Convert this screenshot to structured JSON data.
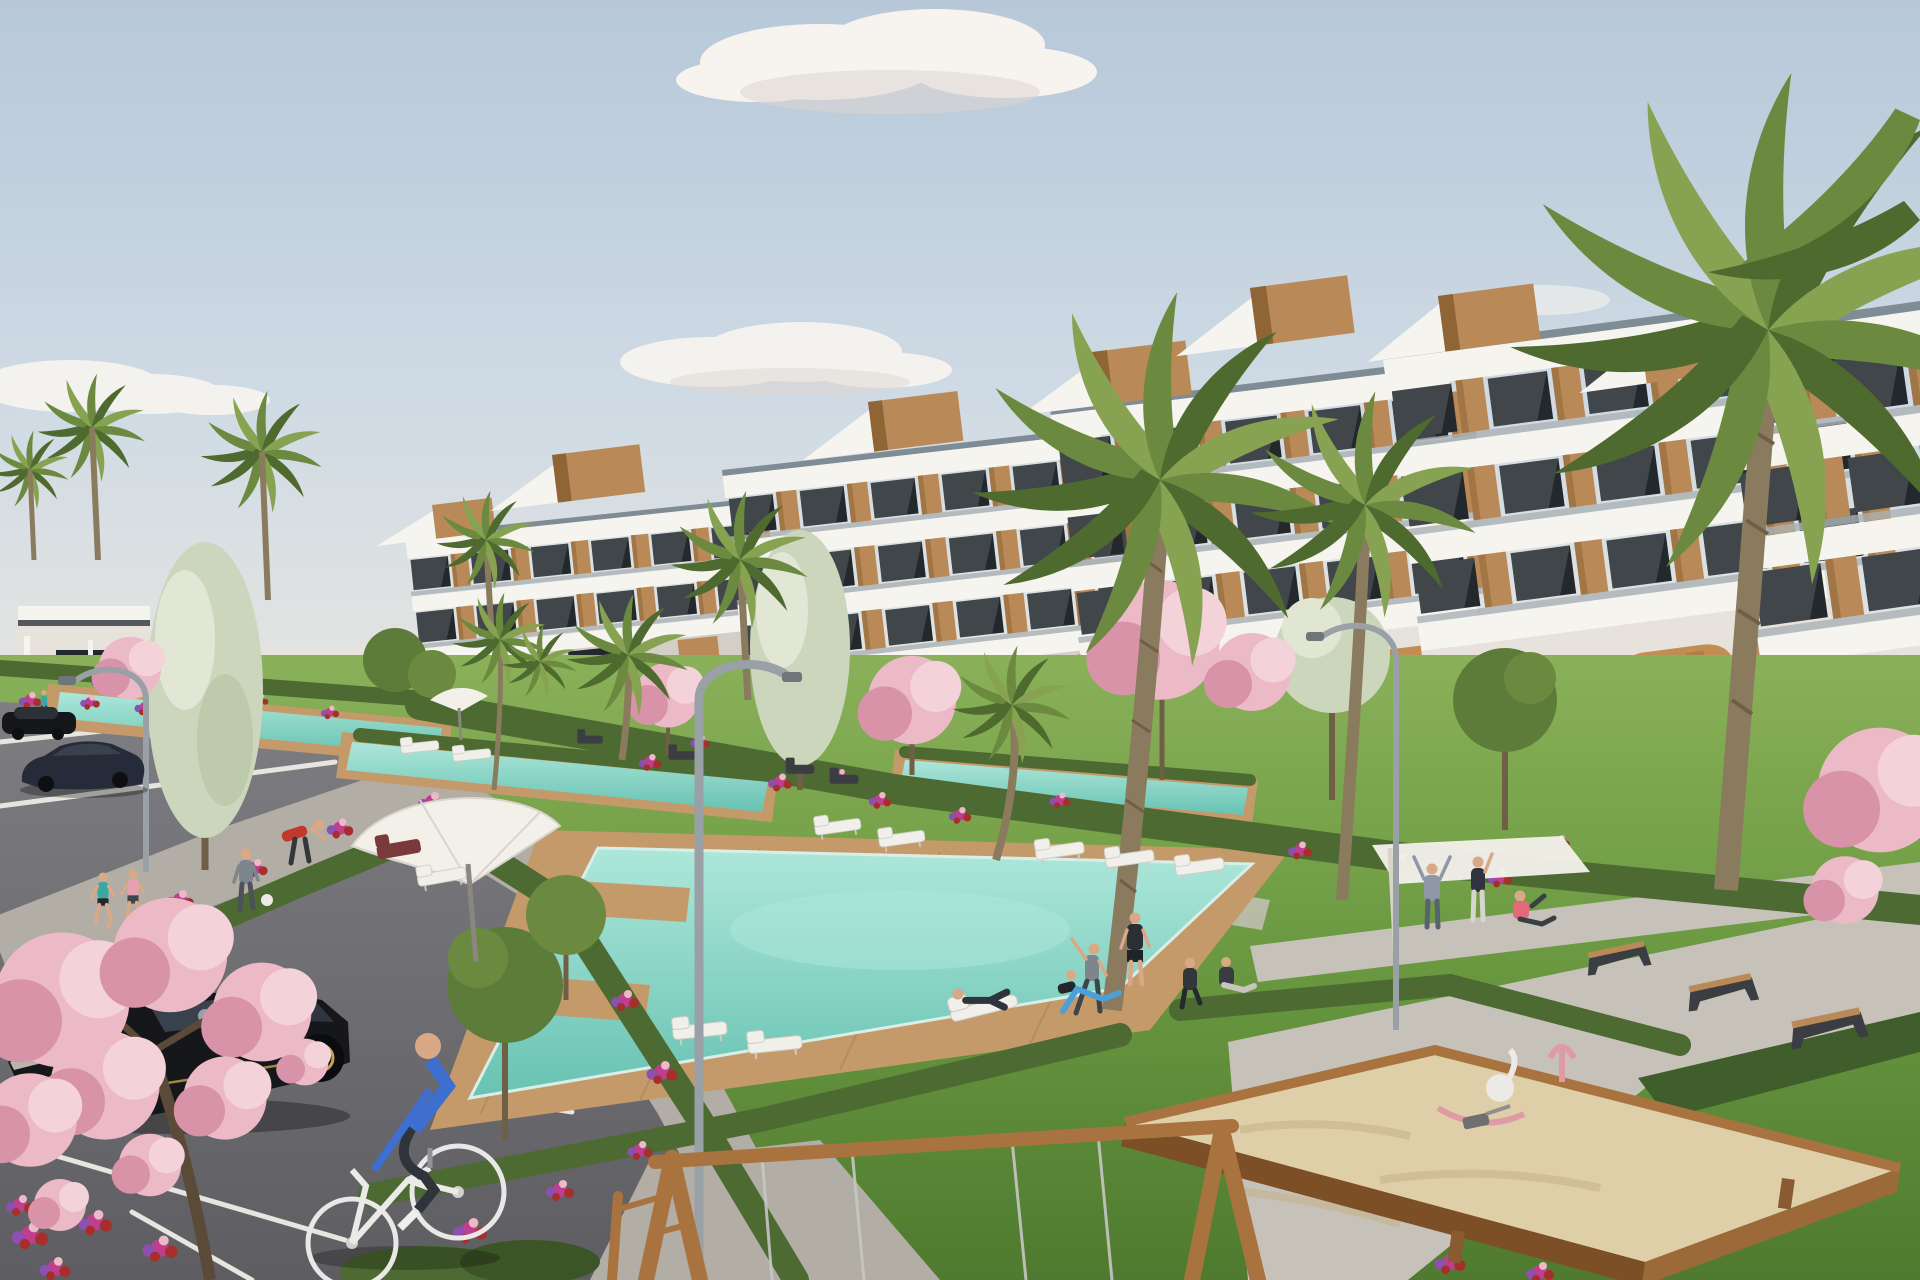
{
  "scene": {
    "description": "Sunny 3D architectural rendering of a modern white terraced apartment complex with rooftop wood accents, communal gardens with palm and pink blossom trees, four turquoise swimming pools with wooden decks, a parking lot with three dark cars and a cyclist, residents jogging, stretching and lounging, and a children's playground with a wooden sandbox and swing frame in the foreground.",
    "setting": "residential resort complex, daytime, clear sky with few clouds",
    "style": "photorealistic CGI render, no visible text"
  },
  "palette": {
    "sky-top": "#b7c8d9",
    "sky-mid": "#cfdae4",
    "horizon": "#e7e6e1",
    "cloud": "#f7f4ef",
    "cloud-shadow": "#ddd6cf",
    "white-sun": "#f6f4ef",
    "white-shade": "#e7e3dc",
    "band-shadow": "#d3cfc7",
    "roof-strip": "#7f8b95",
    "glass-dark": "#23282c",
    "glass-light": "#aab1b5",
    "wood-light": "#b98a58",
    "wood-dark": "#8f6536",
    "ochre": "#c28d55",
    "ochre-shadow": "#9c6c3c",
    "asphalt": "#727276",
    "asphalt-light": "#7e7e82",
    "line-white": "#e6e5e0",
    "sidewalk": "#b2aea6",
    "plaza": "#c6c2b9",
    "ivy": "#3f5e2c",
    "grass-light": "#8ab159",
    "grass-mid": "#699840",
    "grass-dark": "#4f7a2f",
    "hedge": "#4c6a31",
    "hedge-dark": "#3c5526",
    "pool": "#8fdacc",
    "pool-light": "#ade7da",
    "pool-deep": "#68c2b2",
    "deck": "#c59a6a",
    "deck-dark": "#a87f52",
    "flower-magenta": "#bf3f8e",
    "flower-red": "#a62f2c",
    "flower-purple": "#8d4fb0",
    "blossom-pink": "#ecb9c7",
    "blossom-pale": "#f4d2da",
    "blossom-deep": "#d893a8",
    "sand": "#decfa9",
    "sand-shadow": "#c4b28a",
    "play-wood": "#a9733f",
    "play-wood-dark": "#7c4f26",
    "trunk": "#8a7a5e",
    "trunk-dark": "#6e5f46",
    "palm-light": "#87a352",
    "palm-mid": "#6b8a3f",
    "palm-dark": "#4e6a2e",
    "tree-pale": "#ccd6bd",
    "tree-olive": "#5d7c3a",
    "car-black": "#16171b",
    "car-navy": "#252b38",
    "car-glass": "#39414d",
    "gold": "#c9a24b",
    "lamp-gray": "#99a0a6",
    "white-furniture": "#f1efe9",
    "umbrella-white": "#f3f0ea",
    "red-chair": "#7a3a3c",
    "bench-dark": "#3a3d41",
    "shirt-teal": "#3aa8a0",
    "shirt-pink": "#e8a0b0",
    "shirt-red": "#c0392b",
    "shirt-blue": "#3e6fd0",
    "shirt-gray": "#7d858d",
    "pants-dark": "#2f343a",
    "skin": "#d9a987"
  },
  "objects": {
    "building": {
      "type": "terraced apartment complex",
      "color": "white with wood panels",
      "floors_visible": 4,
      "features": [
        "stepped rooflines",
        "rooftop wood volumes",
        "glass balustrades",
        "ground-floor ochre arcades",
        "roof stairs"
      ]
    },
    "pools": {
      "count": 4,
      "main_pool": "large irregular turquoise pool with wooden deck",
      "lap_pools": 3
    },
    "vegetation": {
      "palm_trees": 12,
      "pink_blossom_trees": 6,
      "pale_poplar_trees": 2,
      "hedges": "trimmed dark green rows",
      "flower_colors": [
        "magenta",
        "red",
        "purple",
        "pink"
      ]
    },
    "parking": {
      "surface": "dark asphalt with white stall lines",
      "cars": [
        {
          "type": "hatchback",
          "color": "black",
          "rims": "gold-trimmed"
        },
        {
          "type": "sedan",
          "color": "dark navy"
        },
        {
          "type": "car",
          "color": "black"
        }
      ]
    },
    "people": {
      "count": 15,
      "activities": [
        "cycling",
        "jogging",
        "walking with ball",
        "stretching",
        "yoga",
        "lounging",
        "sitting",
        "playing"
      ]
    },
    "playground": {
      "sandbox": "wooden frame filled with sand",
      "swing_frame": "timber A-frame with metal cables",
      "toys": [
        "white rocking swan",
        "pink play sculpture",
        "shovel"
      ]
    },
    "furniture": {
      "sun_loungers": 12,
      "benches": 3,
      "umbrellas": 2,
      "shade_sail": 1,
      "street_lamps": 3
    }
  }
}
